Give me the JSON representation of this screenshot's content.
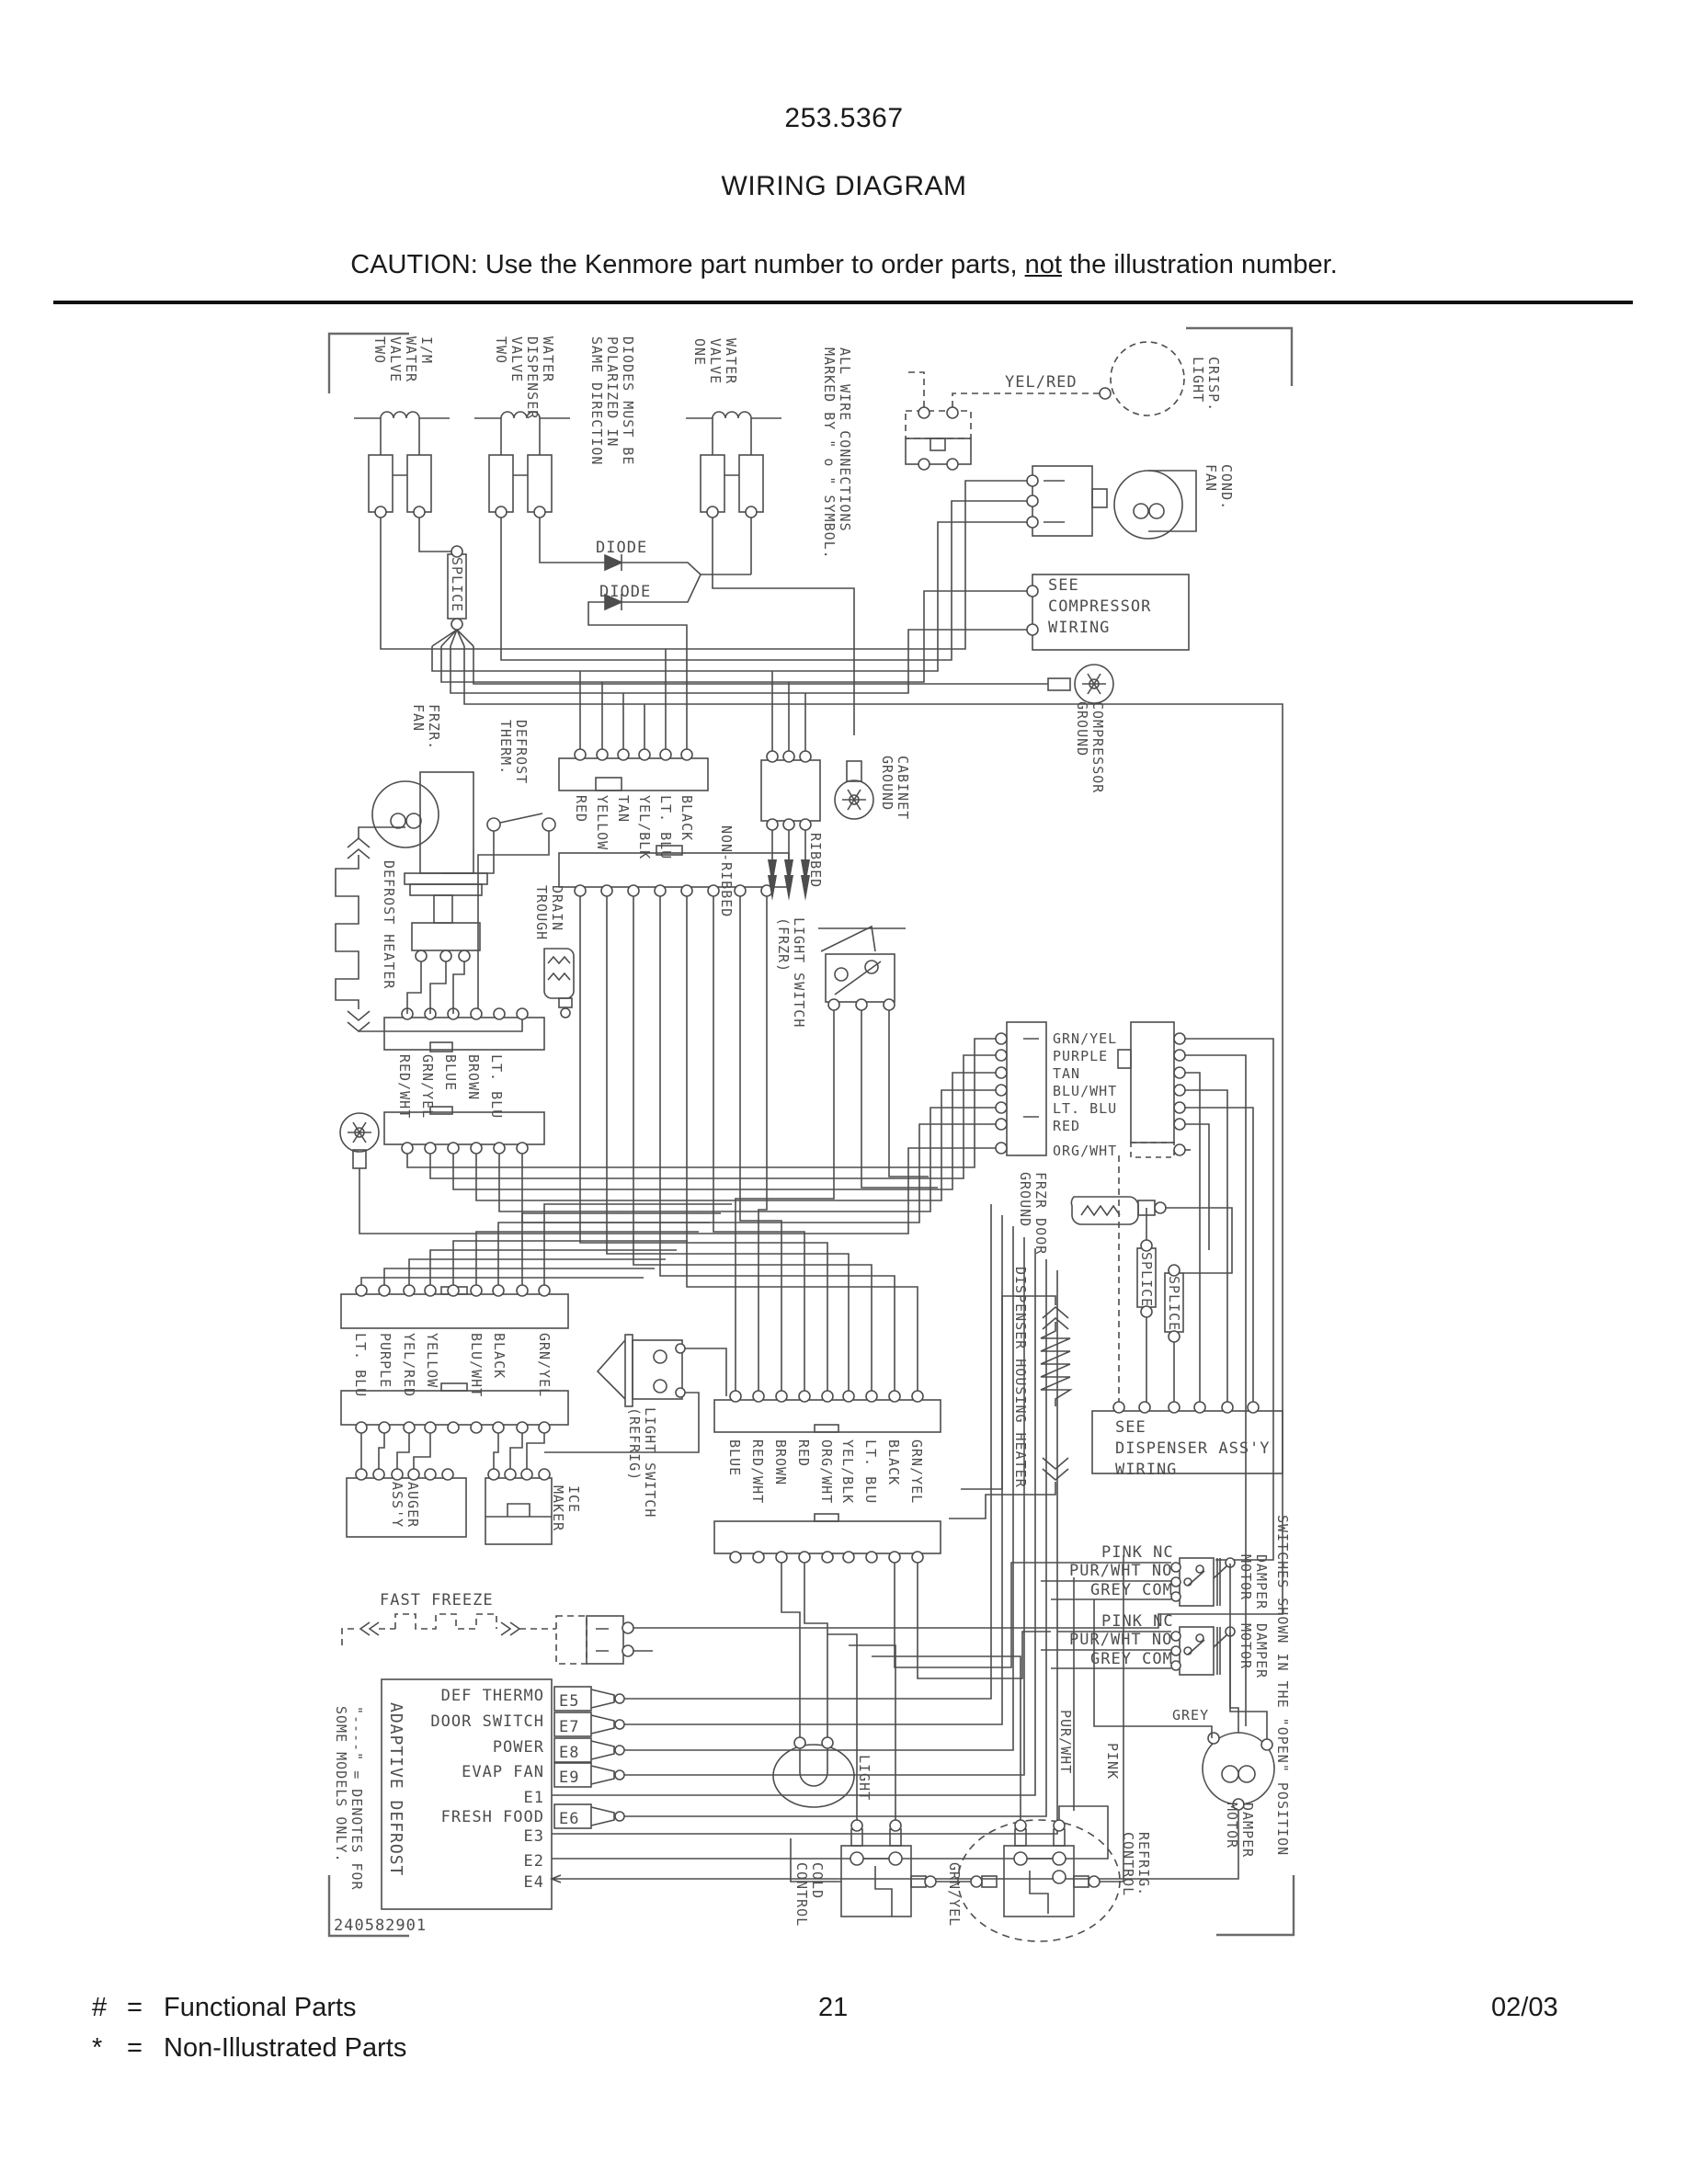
{
  "header": {
    "part_number": "253.5367",
    "title": "WIRING DIAGRAM",
    "caution": {
      "prefix": "CAUTION: Use the Kenmore part number to order parts, ",
      "underlined": "not",
      "suffix": " the illustration number."
    }
  },
  "footer": {
    "functional": {
      "symbol": "#",
      "eq": "=",
      "label": "Functional Parts"
    },
    "non_illustrated": {
      "symbol": "*",
      "eq": "=",
      "label": "Non-Illustrated Parts"
    },
    "page_number": "21",
    "date": "02/03"
  },
  "diagram": {
    "board_number": "240582901",
    "labels": {
      "valve_im": "I/M\nWATER\nVALVE\nTWO",
      "valve_dispenser": "WATER\nDISPENSER\nVALVE\nTWO",
      "diodes_note": "DIODES MUST BE\nPOLARIZED IN\nSAME DIRECTION",
      "valve_one": "WATER\nVALVE\nONE",
      "wire_note": "ALL WIRE CONNECTIONS\nMARKED BY \" o \" SYMBOL.",
      "yel_red": "YEL/RED",
      "crisp_light": "CRISP.\nLIGHT",
      "cond_fan": "COND.\nFAN",
      "see_compressor": "SEE\nCOMPRESSOR\nWIRING",
      "compressor_ground": "COMPRESSOR\nGROUND",
      "diode": "DIODE",
      "splice": "SPLICE",
      "frzr_fan": "FRZR.\nFAN",
      "defrost_therm": "DEFROST\nTHERM.",
      "defrost_heater": "DEFROST HEATER",
      "drain_trough": "DRAIN\nTROUGH",
      "non_ribbed": "NON-RIBBED",
      "ribbed": "RIBBED",
      "cabinet_ground": "CABINET\nGROUND",
      "light_switch_frzr": "LIGHT SWITCH\n(FRZR)",
      "frzr_door_ground": "FRZR DOOR\nGROUND",
      "dispenser_heater": "DISPENSER HOUSING HEATER",
      "see_dispenser": "SEE\nDISPENSER ASS'Y\nWIRING",
      "auger_assy": "AUGER\nASS'Y",
      "ice_maker": "ICE\nMAKER",
      "light_switch_refrig": "LIGHT SWITCH\n(REFRIG)",
      "fast_freeze": "FAST FREEZE",
      "adaptive_defrost": "ADAPTIVE DEFROST",
      "models_note": "\"----\" = DENOTES FOR\nSOME MODELS ONLY.",
      "pink_nc": "PINK NC",
      "pur_wht_no": "PUR/WHT NO",
      "grey_com": "GREY COM",
      "damper_motor": "DAMPER\nMOTOR",
      "switches_note": "SWITCHES SHOWN IN THE \"OPEN\" POSITION",
      "grey": "GREY",
      "pur_wht": "PUR/WHT",
      "pink": "PINK",
      "refrig_control": "REFRIG.\nCONTROL",
      "cold_control": "COLD\nCONTROL",
      "light": "LIGHT",
      "grn_yel": "GRN/YEL"
    },
    "board_rows": [
      "DEF THERMO",
      "DOOR SWITCH",
      "POWER",
      "EVAP FAN",
      "E1",
      "FRESH FOOD",
      "E3",
      "E2",
      "E4"
    ],
    "board_terminals": [
      "E5",
      "E7",
      "E8",
      "E9",
      "E6"
    ],
    "conn_freezer": [
      "RED",
      "YELLOW",
      "TAN",
      "YEL/BLK",
      "LT. BLU",
      "BLACK"
    ],
    "conn_left_mid": [
      "RED/WHT",
      "GRN/YEL",
      "BLUE",
      "BROWN",
      "LT. BLU"
    ],
    "conn_lower_left": [
      "LT. BLU",
      "PURPLE",
      "YEL/RED",
      "YELLOW",
      "BLU/WHT",
      "BLACK",
      "GRN/YEL"
    ],
    "conn_center": [
      "BLUE",
      "RED/WHT",
      "BROWN",
      "RED",
      "ORG/WHT",
      "YEL/BLK",
      "LT. BLU",
      "BLACK",
      "GRN/YEL"
    ],
    "conn_right": [
      "GRN/YEL",
      "PURPLE",
      "TAN",
      "BLU/WHT",
      "LT. BLU",
      "RED",
      "ORG/WHT"
    ]
  }
}
